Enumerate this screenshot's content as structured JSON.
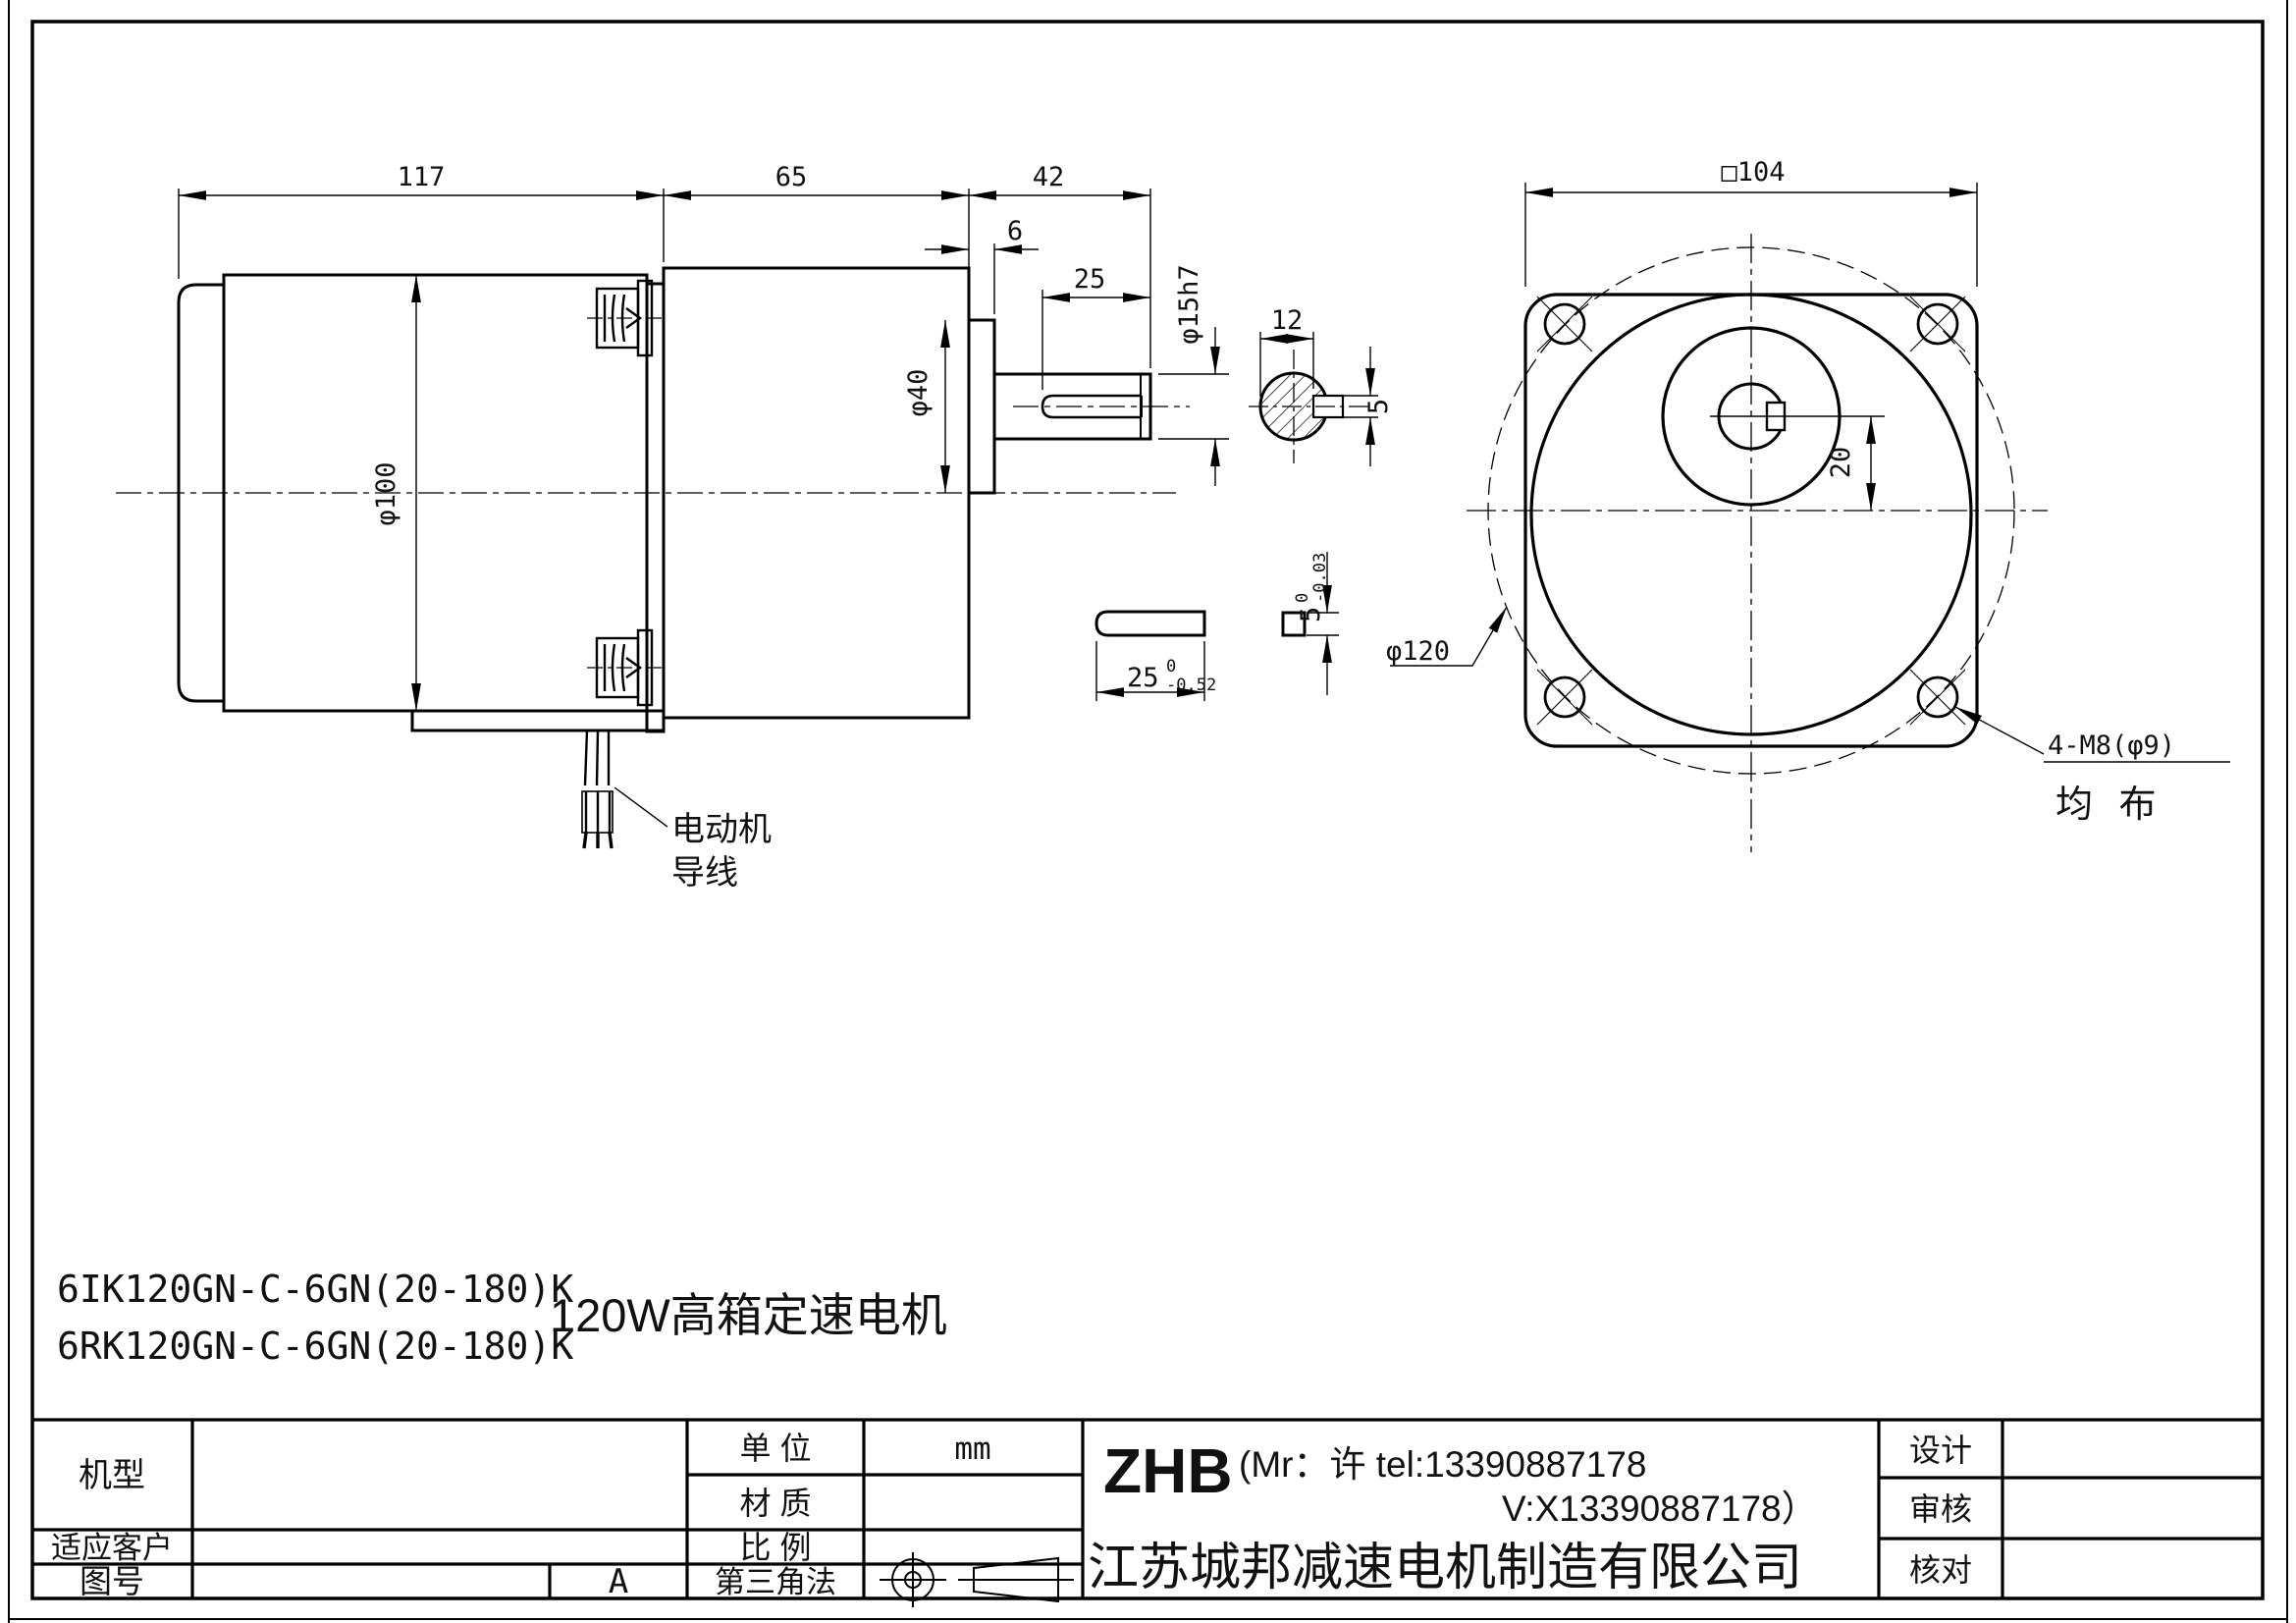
{
  "colors": {
    "line": "#000000",
    "background": "#ffffff"
  },
  "side_view": {
    "dim_motor_length": "117",
    "dim_gearbox_length": "65",
    "dim_shaft_length": "42",
    "dim_boss_thickness": "6",
    "dim_keyway_length": "25",
    "dim_motor_diameter": "φ100",
    "dim_boss_diameter": "φ40",
    "dim_shaft_diameter": "φ15h7",
    "lead_wire_label_line1": "电动机",
    "lead_wire_label_line2": "导线"
  },
  "shaft_section": {
    "dim_across_flat": "12",
    "dim_key_width": "5"
  },
  "key_detail": {
    "dim_length": "25",
    "length_tol_upper": "0",
    "length_tol_lower": "-0.52",
    "dim_height": "5",
    "height_tol_upper": "0",
    "height_tol_lower": "-0.03"
  },
  "front_view": {
    "dim_square": "□104",
    "dim_shaft_offset": "20",
    "dim_bolt_circle": "φ120",
    "holes_callout": "4-M8(φ9)",
    "holes_note": "均 布"
  },
  "notes": {
    "model_line1": "6IK120GN-C-6GN(20-180)K",
    "model_line2": "6RK120GN-C-6GN(20-180)K",
    "product_title": "120W高箱定速电机"
  },
  "title_block": {
    "model_label": "机型",
    "customer_label": "适应客户",
    "drawing_no_label": "图号",
    "revision": "A",
    "unit_label": "单  位",
    "unit_value": "mm",
    "material_label": "材  质",
    "scale_label": "比  例",
    "projection_label": "第三角法",
    "brand": "ZHB",
    "contact_line1": "(Mr：许 tel:13390887178",
    "contact_line2": "V:X13390887178）",
    "company": "江苏城邦减速电机制造有限公司",
    "design_label": "设计",
    "review_label": "审核",
    "check_label": "核对"
  }
}
